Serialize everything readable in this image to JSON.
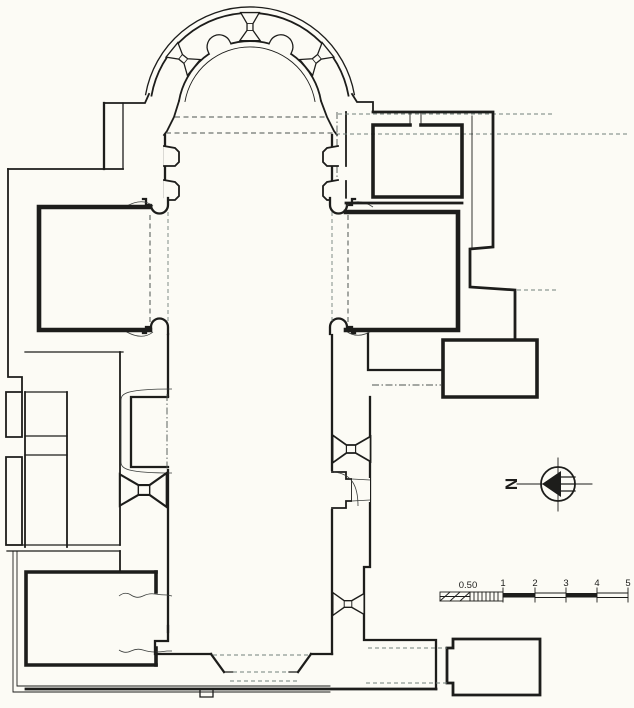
{
  "drawing": {
    "paper_color": "#fcfbf5",
    "ink_color": "#1d1d1b",
    "dash_color": "#4c5350"
  },
  "north_indicator": {
    "label": "N"
  },
  "scale_bar": {
    "labels": [
      "0.50",
      "1",
      "2",
      "3",
      "4",
      "5"
    ]
  }
}
